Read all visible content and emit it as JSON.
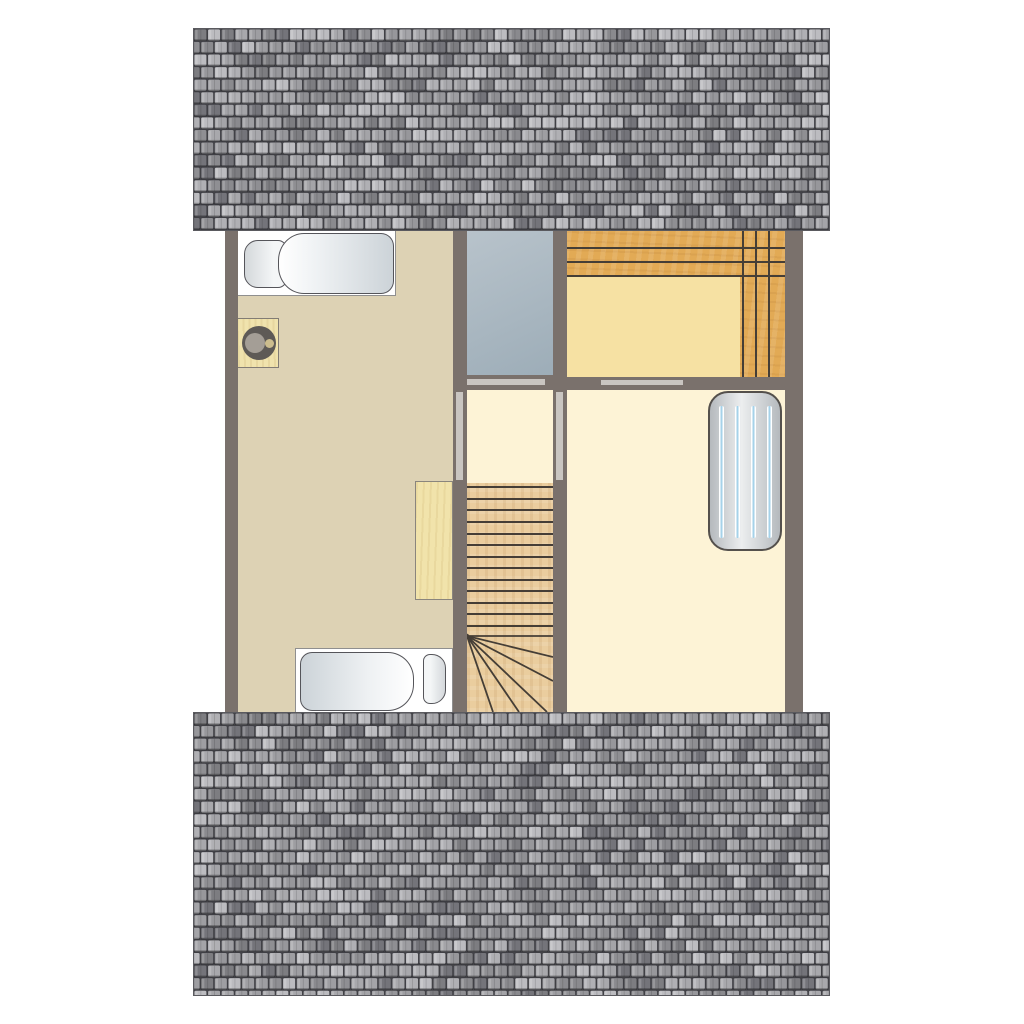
{
  "scene": {
    "type": "attic-floorplan",
    "description": "Top-down architectural floor plan of an attic storey flanked by two grey tiled roof slopes; no text labels are visible",
    "rooms": [
      {
        "id": "bedroom-left",
        "floor_color": "#ddd2b4",
        "furniture": [
          "single-bed-top",
          "side-table-with-stool",
          "desk",
          "single-bed-bottom"
        ]
      },
      {
        "id": "void-opening",
        "floor_color": "#aebcc5",
        "furniture": []
      },
      {
        "id": "landing",
        "floor_color": "#fdf3d6",
        "furniture": [
          "railing-left",
          "railing-right"
        ]
      },
      {
        "id": "staircase",
        "floor_color": "#eacd9e",
        "straight_treads": 13,
        "winder_treads": 6
      },
      {
        "id": "storage-room-top-right",
        "floor_color": "#e2aa55",
        "furniture": [
          "built-in-closet-shelves",
          "inset-panel"
        ]
      },
      {
        "id": "bedroom-right",
        "floor_color": "#fdf3d6",
        "furniture": [
          "radiator"
        ]
      }
    ]
  },
  "palette": {
    "wall": "#7a716c",
    "floor_tan": "#ddd2b4",
    "floor_cream": "#fdf3d6",
    "void_top": "#b8c3cb",
    "void_bottom": "#9dadb8",
    "wood_closet": "#e2aa55",
    "closet_inset": "#f6e1a3",
    "wood_stairs": "#eacd9e",
    "wood_desk": "#f1e3ab",
    "wood_table": "#f0e3ad",
    "line_dark": "#453e36",
    "bar_light": "#c9c5c1",
    "bed_fill": "#ffffff",
    "bed_outline": "#55555a",
    "duvet_light": "#eef1f3",
    "duvet_shade": "#ccd3d8",
    "radiator_border": "#54504c",
    "radiator_fill_a": "#b5b9bd",
    "radiator_fill_b": "#eceeef",
    "radiator_stripe_blue": "#a5d2e9",
    "stool_outer": "#5e5a56",
    "stool_mid": "#a49e96",
    "stool_center": "#ccbd8e",
    "roof_gap": "#45454a"
  },
  "roof": {
    "tile_width": 13.7,
    "tile_height": 12.7,
    "seed": 987654321,
    "palette": [
      "#a4a4a8",
      "#97979b",
      "#8a8a8e",
      "#9e9ea2",
      "#7d7d81",
      "#b0b0b4",
      "#8f8f93",
      "#a8a8ac",
      "#74747a",
      "#bcbcc0"
    ],
    "sections": [
      {
        "id": "roof-top",
        "width": 637,
        "height": 203
      },
      {
        "id": "roof-bottom",
        "width": 637,
        "height": 284
      }
    ]
  },
  "stairs": {
    "width": 86,
    "height": 229,
    "tread_line_ys": [
      3,
      15,
      26,
      38,
      50,
      61,
      73,
      84,
      96,
      107,
      119,
      130,
      142
    ],
    "fan_origin": [
      0,
      153
    ],
    "fan_targets": [
      [
        86,
        153
      ],
      [
        86,
        174
      ],
      [
        86,
        198
      ],
      [
        80,
        229
      ],
      [
        52,
        229
      ],
      [
        26,
        229
      ]
    ]
  }
}
